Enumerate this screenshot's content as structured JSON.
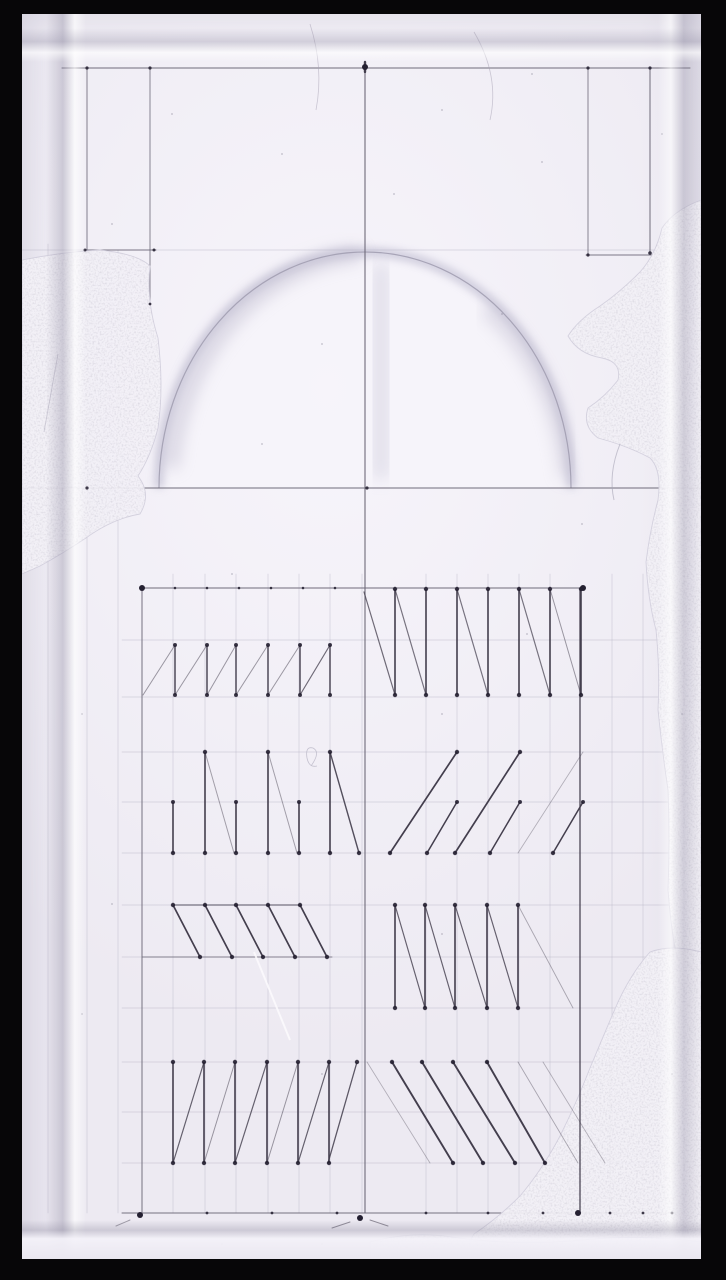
{
  "figure": {
    "kind": "photograph-of-incised-architectural-drawing",
    "has_text": false
  },
  "palette": {
    "frame": "#070608",
    "paper": "#edeaf2",
    "paper_hi": "#f6f4fa",
    "faint": "#b5b2c3",
    "med": "#6f6b7a",
    "dark": "#433e4d",
    "dot": "#242031",
    "shadow": "#c5c2d5",
    "shadow2": "#b7b3c8",
    "plaster": "#f3f1f7",
    "plaster_edge": "#d3d0de",
    "scratch": "#a7a3b5",
    "white_scratch": "#fbfafd"
  },
  "photo": {
    "x": 22,
    "y": 14,
    "w": 679,
    "h": 1245
  },
  "arch": {
    "cx": 343,
    "cy": 474,
    "rx": 206,
    "ry": 236
  },
  "drawing": {
    "grid_v": [
      [
        26,
        230,
        1199
      ],
      [
        65,
        54,
        1199
      ],
      [
        96,
        236,
        1199
      ],
      [
        151,
        560,
        1199
      ],
      [
        183,
        560,
        1199
      ],
      [
        214,
        560,
        1199
      ],
      [
        246,
        560,
        1199
      ],
      [
        277,
        560,
        1199
      ],
      [
        308,
        560,
        1199
      ],
      [
        340,
        560,
        1199
      ],
      [
        404,
        560,
        1199
      ],
      [
        435,
        560,
        1199
      ],
      [
        466,
        560,
        1199
      ],
      [
        497,
        560,
        1199
      ],
      [
        528,
        560,
        1199
      ],
      [
        590,
        560,
        1199
      ],
      [
        621,
        560,
        1199
      ],
      [
        652,
        236,
        1212
      ]
    ],
    "grid_h": [
      [
        236,
        0,
        679
      ],
      [
        626,
        100,
        645
      ],
      [
        683,
        100,
        645
      ],
      [
        738,
        100,
        660
      ],
      [
        788,
        100,
        660
      ],
      [
        839,
        100,
        660
      ],
      [
        891,
        100,
        660
      ],
      [
        943,
        100,
        660
      ],
      [
        994,
        100,
        660
      ],
      [
        1048,
        100,
        668
      ],
      [
        1098,
        100,
        668
      ],
      [
        1149,
        100,
        668
      ]
    ],
    "med_lines": [
      [
        40,
        54,
        668,
        54,
        1.1,
        1
      ],
      [
        343,
        54,
        343,
        1199,
        1.1,
        1
      ],
      [
        65,
        54,
        65,
        236,
        0.9,
        0.9
      ],
      [
        128,
        54,
        128,
        290,
        0.9,
        0.9
      ],
      [
        566,
        54,
        566,
        241,
        0.9,
        0.9
      ],
      [
        628,
        54,
        628,
        239,
        1,
        1
      ],
      [
        63,
        236,
        134,
        236,
        0.9,
        0.9
      ],
      [
        564,
        241,
        630,
        241,
        0.9,
        0.9
      ],
      [
        0,
        474,
        679,
        474,
        1,
        1
      ],
      [
        120,
        574,
        561,
        574,
        1.1,
        1
      ],
      [
        120,
        574,
        120,
        1199,
        1,
        0.95
      ],
      [
        100,
        1199,
        650,
        1199,
        1,
        0.95
      ],
      [
        120,
        943,
        310,
        943,
        0.9,
        0.8
      ],
      [
        151,
        891,
        278,
        891,
        1.2,
        0.95
      ],
      [
        588,
        1048,
        588,
        1196,
        0.9,
        0.55
      ]
    ],
    "dark_lines": [
      [
        373,
        575,
        373,
        681
      ],
      [
        404,
        575,
        404,
        681
      ],
      [
        435,
        575,
        435,
        681
      ],
      [
        466,
        575,
        466,
        681
      ],
      [
        497,
        575,
        497,
        681
      ],
      [
        528,
        575,
        528,
        681
      ],
      [
        559,
        575,
        559,
        681
      ],
      [
        342,
        578,
        373,
        681,
        1.2,
        0.75
      ],
      [
        373,
        575,
        404,
        681,
        1.2,
        0.7
      ],
      [
        435,
        575,
        466,
        681,
        1.2,
        0.7
      ],
      [
        497,
        575,
        528,
        681,
        1.2,
        0.7
      ],
      [
        528,
        575,
        559,
        681,
        1,
        0.5
      ],
      [
        153,
        631,
        153,
        681,
        1.4,
        1
      ],
      [
        185,
        631,
        185,
        681,
        1.4,
        1
      ],
      [
        214,
        631,
        214,
        681,
        1.4,
        1
      ],
      [
        246,
        631,
        246,
        681,
        1.4,
        1
      ],
      [
        278,
        631,
        278,
        681,
        1.4,
        1
      ],
      [
        308,
        631,
        308,
        681,
        1.4,
        1
      ],
      [
        121,
        681,
        153,
        631,
        1,
        0.5
      ],
      [
        153,
        681,
        185,
        631,
        1,
        0.5
      ],
      [
        185,
        681,
        214,
        631,
        1,
        0.5
      ],
      [
        214,
        681,
        246,
        631,
        1,
        0.5
      ],
      [
        246,
        681,
        278,
        631,
        1,
        0.5
      ],
      [
        278,
        681,
        308,
        631,
        1.2,
        0.75
      ],
      [
        183,
        738,
        183,
        839
      ],
      [
        246,
        738,
        246,
        839
      ],
      [
        308,
        738,
        308,
        839
      ],
      [
        151,
        788,
        151,
        839
      ],
      [
        214,
        788,
        214,
        839
      ],
      [
        277,
        788,
        277,
        839
      ],
      [
        308,
        738,
        337,
        839,
        1.4,
        0.9
      ],
      [
        183,
        738,
        212,
        839,
        1,
        0.45
      ],
      [
        246,
        738,
        275,
        839,
        1,
        0.45
      ],
      [
        368,
        839,
        435,
        738,
        1.7,
        1
      ],
      [
        433,
        839,
        498,
        738,
        1.7,
        1
      ],
      [
        405,
        839,
        435,
        788,
        1.5,
        1
      ],
      [
        468,
        839,
        498,
        788,
        1.5,
        1
      ],
      [
        531,
        839,
        561,
        788,
        1.5,
        1
      ],
      [
        496,
        839,
        561,
        738,
        0.9,
        0.35
      ],
      [
        151,
        891,
        178,
        943,
        1.7,
        1
      ],
      [
        183,
        891,
        210,
        943,
        1.7,
        1
      ],
      [
        214,
        891,
        241,
        943,
        1.7,
        1
      ],
      [
        246,
        891,
        273,
        943,
        1.7,
        1
      ],
      [
        278,
        891,
        305,
        943,
        1.7,
        1
      ],
      [
        373,
        891,
        373,
        994
      ],
      [
        403,
        891,
        403,
        994
      ],
      [
        433,
        891,
        433,
        994
      ],
      [
        465,
        891,
        465,
        994
      ],
      [
        496,
        891,
        496,
        994
      ],
      [
        373,
        891,
        403,
        994,
        1.2,
        0.8
      ],
      [
        403,
        891,
        433,
        994,
        1.2,
        0.8
      ],
      [
        433,
        891,
        465,
        994,
        1.2,
        0.8
      ],
      [
        465,
        891,
        496,
        994,
        1.2,
        0.8
      ],
      [
        496,
        891,
        551,
        994,
        0.9,
        0.4
      ],
      [
        151,
        1048,
        151,
        1149
      ],
      [
        182,
        1048,
        182,
        1149
      ],
      [
        213,
        1048,
        213,
        1149
      ],
      [
        245,
        1048,
        245,
        1149
      ],
      [
        276,
        1048,
        276,
        1149
      ],
      [
        307,
        1048,
        307,
        1149
      ],
      [
        151,
        1149,
        182,
        1048,
        1.2,
        0.8
      ],
      [
        182,
        1149,
        213,
        1048,
        1,
        0.5
      ],
      [
        213,
        1149,
        245,
        1048,
        1.2,
        0.8
      ],
      [
        245,
        1149,
        276,
        1048,
        1,
        0.5
      ],
      [
        276,
        1149,
        307,
        1048,
        1.2,
        0.8
      ],
      [
        306,
        1149,
        335,
        1048,
        1.3,
        0.85
      ],
      [
        370,
        1048,
        431,
        1149,
        1.9,
        1
      ],
      [
        400,
        1048,
        461,
        1149,
        1.9,
        1
      ],
      [
        431,
        1048,
        493,
        1149,
        1.9,
        1
      ],
      [
        465,
        1048,
        523,
        1149,
        1.9,
        1
      ],
      [
        345,
        1048,
        408,
        1149,
        0.9,
        0.35
      ],
      [
        496,
        1048,
        556,
        1149,
        0.9,
        0.4
      ],
      [
        521,
        1048,
        583,
        1149,
        0.9,
        0.35
      ],
      [
        558,
        574,
        558,
        1199,
        1.3,
        0.95
      ],
      [
        343,
        48,
        343,
        58,
        2.4,
        1
      ],
      [
        328,
        1208,
        310,
        1214,
        1,
        0.55
      ],
      [
        348,
        1206,
        366,
        1212,
        1,
        0.55
      ],
      [
        108,
        1206,
        94,
        1212,
        1,
        0.45
      ]
    ],
    "dot_rows": [
      {
        "y": 575,
        "xs": [
          373,
          404,
          435,
          466,
          497,
          528,
          559
        ],
        "r": 2.2
      },
      {
        "y": 681,
        "xs": [
          373,
          404,
          435,
          466,
          497,
          528,
          559
        ],
        "r": 2.2
      },
      {
        "y": 631,
        "xs": [
          153,
          185,
          214,
          246,
          278,
          308
        ],
        "r": 2
      },
      {
        "y": 681,
        "xs": [
          153,
          185,
          214,
          246,
          278,
          308
        ],
        "r": 2
      },
      {
        "y": 574,
        "xs": [
          153,
          185,
          217,
          249,
          281,
          313
        ],
        "r": 1.3
      },
      {
        "y": 738,
        "xs": [
          183,
          246,
          308,
          435,
          498
        ],
        "r": 2.2
      },
      {
        "y": 788,
        "xs": [
          151,
          214,
          277,
          435,
          498,
          561
        ],
        "r": 2
      },
      {
        "y": 839,
        "xs": [
          151,
          183,
          214,
          246,
          277,
          308,
          337,
          368,
          405,
          433,
          468,
          531
        ],
        "r": 2.2
      },
      {
        "y": 891,
        "xs": [
          151,
          183,
          214,
          246,
          278,
          373,
          403,
          433,
          465,
          496
        ],
        "r": 2.2
      },
      {
        "y": 943,
        "xs": [
          178,
          210,
          241,
          273,
          305
        ],
        "r": 2.2
      },
      {
        "y": 994,
        "xs": [
          373,
          403,
          433,
          465,
          496
        ],
        "r": 2.2
      },
      {
        "y": 1048,
        "xs": [
          151,
          182,
          213,
          245,
          276,
          307,
          335,
          370,
          400,
          431,
          465
        ],
        "r": 2.2
      },
      {
        "y": 1149,
        "xs": [
          151,
          182,
          213,
          245,
          276,
          307,
          431,
          461,
          493,
          523
        ],
        "r": 2.2
      },
      {
        "y": 1199,
        "xs": [
          185,
          250,
          315,
          404,
          466,
          521,
          588,
          621,
          650
        ],
        "r": 1.4
      },
      {
        "y": 54,
        "xs": [
          65,
          128,
          566,
          628
        ],
        "r": 1.6
      },
      {
        "y": 236,
        "xs": [
          63,
          132
        ],
        "r": 1.5
      },
      {
        "y": 241,
        "xs": [
          566
        ],
        "r": 1.6
      },
      {
        "y": 239,
        "xs": [
          628
        ],
        "r": 1.8
      },
      {
        "y": 474,
        "xs": [
          65,
          345
        ],
        "r": 1.6
      },
      {
        "y": 290,
        "xs": [
          128
        ],
        "r": 1.4
      }
    ],
    "dots_big": [
      [
        118,
        1201
      ],
      [
        338,
        1204
      ],
      [
        556,
        1199
      ],
      [
        120,
        574
      ],
      [
        561,
        574
      ],
      [
        343,
        53
      ]
    ],
    "blobs": [
      "M0,246 Q40,238 78,236 Q116,240 128,252 Q124,286 136,324 Q142,374 136,414 Q129,442 116,462 Q130,480 118,500 Q90,505 64,524 Q40,540 18,552 L0,560 Z",
      "M679,186 Q652,196 640,214 Q634,240 618,258 Q598,278 578,292 Q556,306 546,322 Q556,340 580,344 Q600,348 596,366 Q584,382 566,394 Q560,412 576,424 Q606,432 628,444 Q640,456 636,486 Q628,516 624,548 Q626,586 634,616 Q638,656 636,696 Q640,736 646,776 Q648,826 646,876 Q650,926 656,946 L679,952 Z",
      "M679,938 Q650,930 628,938 Q610,958 596,988 Q582,1020 568,1054 Q554,1090 538,1122 Q520,1156 498,1182 Q476,1204 452,1220 Q444,1232 452,1240 L679,1240 Z",
      "M348,1228 Q392,1216 436,1224 Q500,1232 560,1226 Q620,1220 679,1228 L679,1245 L348,1245 Z"
    ],
    "scratches": [
      {
        "d": "M288,10 q14,44 6,86",
        "w": 0.8,
        "op": 0.55
      },
      {
        "d": "M452,18 q26,44 16,88",
        "w": 0.8,
        "op": 0.55
      },
      {
        "d": "M598,430 q-12,30 -6,56",
        "w": 1,
        "op": 0.6
      },
      {
        "d": "M36,340 q-8,44 -14,78",
        "w": 0.9,
        "op": 0.5
      },
      {
        "d": "M289,752 q10,-14 2,-18 q-8,-2 -6,10 q2,10 10,8",
        "w": 0.8,
        "op": 0.6
      }
    ],
    "white_scratch": {
      "d": "M232,938 l36,88",
      "w": 2,
      "op": 0.85
    },
    "specks": [
      [
        150,
        100
      ],
      [
        260,
        140
      ],
      [
        420,
        96
      ],
      [
        520,
        148
      ],
      [
        640,
        120
      ],
      [
        90,
        210
      ],
      [
        300,
        330
      ],
      [
        480,
        300
      ],
      [
        560,
        510
      ],
      [
        210,
        560
      ],
      [
        60,
        700
      ],
      [
        420,
        700
      ],
      [
        660,
        700
      ],
      [
        90,
        890
      ],
      [
        420,
        920
      ],
      [
        60,
        1000
      ],
      [
        300,
        1060
      ],
      [
        650,
        1060
      ],
      [
        200,
        1230
      ],
      [
        300,
        1230
      ],
      [
        510,
        60
      ],
      [
        372,
        180
      ],
      [
        240,
        430
      ],
      [
        505,
        620
      ]
    ]
  }
}
